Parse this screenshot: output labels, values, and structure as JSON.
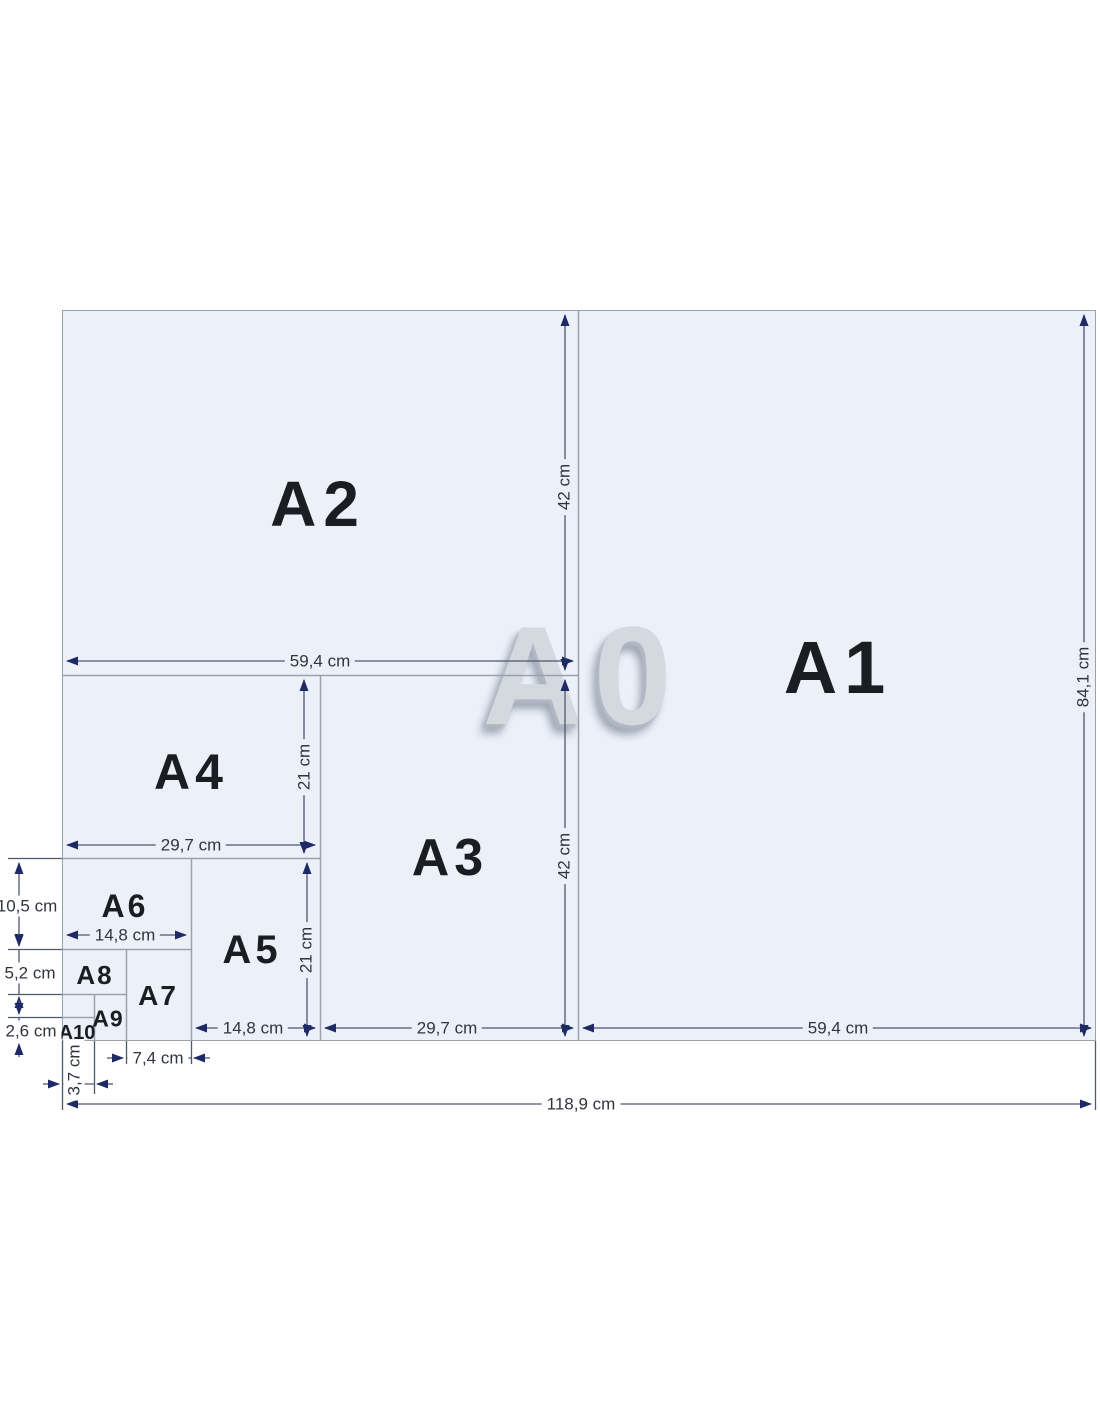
{
  "watermark": {
    "label": "A0"
  },
  "sheets": {
    "a1": "A1",
    "a2": "A2",
    "a3": "A3",
    "a4": "A4",
    "a5": "A5",
    "a6": "A6",
    "a7": "A7",
    "a8": "A8",
    "a9": "A9",
    "a10": "A10"
  },
  "dims": {
    "a2_width": "59,4 cm",
    "a2_height": "42 cm",
    "a3_height": "42 cm",
    "a1_height": "84,1 cm",
    "a4_width": "29,7 cm",
    "a4_height": "21 cm",
    "a6_width": "14,8 cm",
    "a6_height": "10,5 cm",
    "a8_height": "5,2 cm",
    "a10_height": "2,6 cm",
    "a10_width": "3,7 cm",
    "a7_width": "7,4 cm",
    "a5_width": "14,8 cm",
    "a5_height": "21 cm",
    "a3_width": "29,7 cm",
    "a1_width": "59,4 cm",
    "a0_width": "118,9 cm"
  },
  "colors": {
    "background": "#ffffff",
    "sheet_fill": "#ecf1f9",
    "sheet_outline": "#99a1ab",
    "dimension_line": "#4d576e",
    "arrowhead": "#1d2a66",
    "dimension_text": "#30353d",
    "sheet_label_text": "#1a1d21",
    "watermark_text": "#d4d8df"
  }
}
